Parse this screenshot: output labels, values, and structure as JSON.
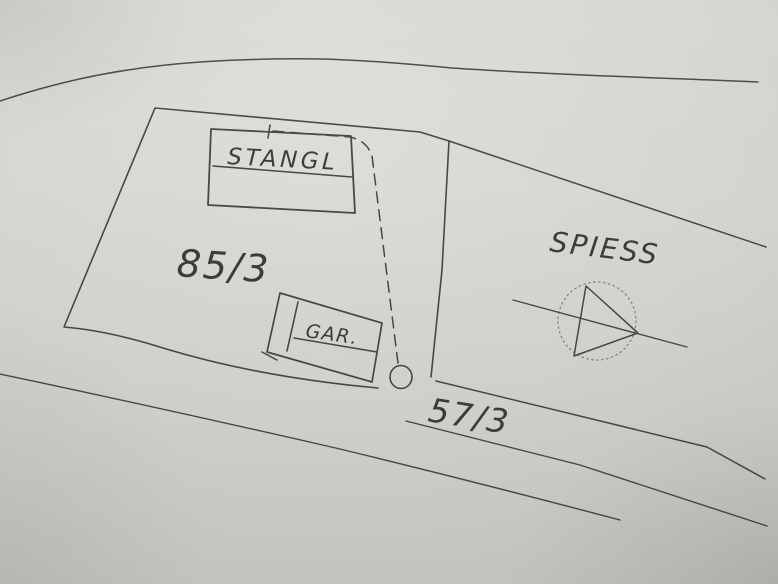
{
  "document": {
    "kind": "hand-drawn cadastral site sketch (photo of paper)",
    "labels": {
      "main_building": "STANGL",
      "left_parcel_number": "85/3",
      "garage_building": "GAR.",
      "right_parcel_owner": "SPIESS",
      "road_parcel_number": "57/3"
    },
    "symbols": {
      "triangulation_point": "triangle inside dotted circle crossed by boundary line",
      "boundary_marker": "small circle at end of dashed boundary line"
    },
    "colors": {
      "paper": "#d7d5d0",
      "paper_highlight": "#dfddd8",
      "paper_shadow": "#c3c1bc",
      "ink": "#4a4842",
      "text_ink": "#3f3d38"
    }
  }
}
